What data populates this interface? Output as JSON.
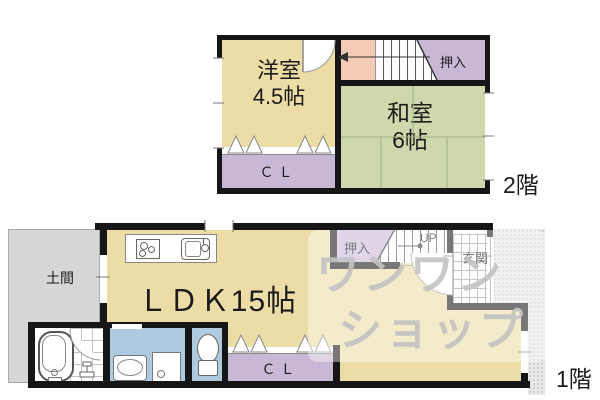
{
  "floor2": {
    "label": "2階",
    "western_room": {
      "name": "洋室",
      "size": "4.5帖"
    },
    "japanese_room": {
      "name": "和室",
      "size": "6帖"
    },
    "oshiire": "押入",
    "closet": "ＣＬ"
  },
  "floor1": {
    "label": "1階",
    "ldk": "ＬＤＫ15帖",
    "doma": "土間",
    "oshiire": "押入",
    "up": "UP",
    "genkan": "玄関",
    "closet": "ＣＬ"
  },
  "watermark": {
    "line1": "ワンワン",
    "line2": "ショップ"
  },
  "colors": {
    "room_beige": "#ecdca6",
    "tatami_green": "#cfd8ad",
    "closet_purple": "#c9b7d6",
    "landing_pink": "#f4cab6",
    "sanitary_blue": "#aecade",
    "doma_gray": "#d6d6d6",
    "wall_black": "#161616"
  }
}
